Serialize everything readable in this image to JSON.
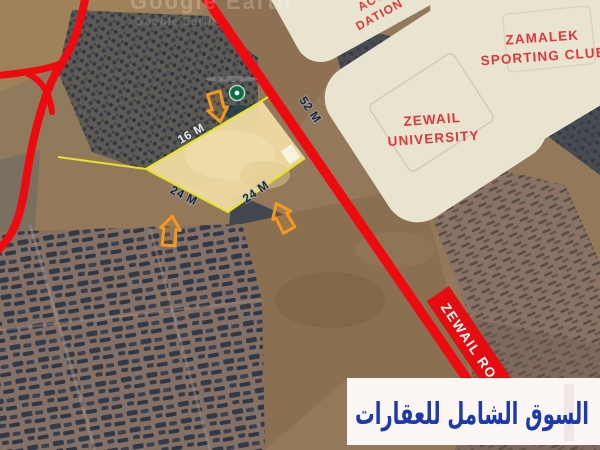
{
  "watermark": {
    "primary": "Google Earth",
    "secondary": "Google Earth"
  },
  "pois": {
    "zamalek": {
      "line1": "ZAMALEK",
      "line2": "SPORTING CLUB"
    },
    "university": {
      "line1": "ZEWAIL",
      "line2": "UNIVERSITY"
    },
    "foundation_partial": {
      "line1": "ACOUB",
      "line2": "DATION"
    }
  },
  "road": {
    "banner": "ZEWAIL ROAD",
    "frontage": "52 M"
  },
  "plot": {
    "top_edge": "16 M",
    "southwest_edge": "24 M",
    "southeast_edge": "24 M"
  },
  "footer": {
    "brand": "السوق الشامل للعقارات"
  },
  "colors": {
    "road_red": "#ee0a0e",
    "banner_red": "#e60d10",
    "plot_fill": "#ecd9a0",
    "boundary_yellow": "#e6e42a",
    "arrow_orange": "#f29a1f",
    "poi_text_red": "#df363a",
    "poi_fill": "#e9e4d0",
    "brand_blue": "#1d3aad",
    "strip_white": "#fcf7f5",
    "marker_green": "#0e6b43"
  }
}
